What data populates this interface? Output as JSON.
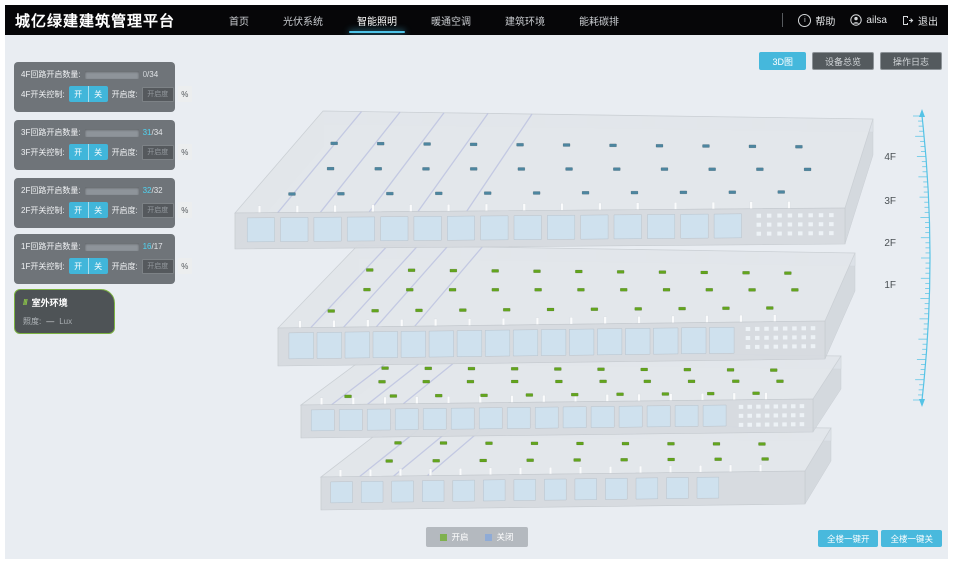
{
  "header": {
    "title": "城亿绿建建筑管理平台",
    "nav": [
      {
        "label": "首页"
      },
      {
        "label": "光伏系统"
      },
      {
        "label": "智能照明"
      },
      {
        "label": "暖通空调"
      },
      {
        "label": "建筑环境"
      },
      {
        "label": "能耗碳排"
      }
    ],
    "active_nav": "智能照明",
    "help_label": "帮助",
    "username": "ailsa",
    "logout_label": "退出"
  },
  "toolbar": {
    "view_3d": "3D图",
    "device_overview": "设备总览",
    "operation_log": "操作日志"
  },
  "floor_panels": [
    {
      "floor": "4F",
      "count_label": "4F回路开启数量:",
      "open": 0,
      "total": 34,
      "open_display": "0",
      "total_display": "/34",
      "switch_label": "4F开关控制:",
      "on_label": "开",
      "off_label": "关",
      "dim_label": "开启度:",
      "dim_placeholder": "开启度",
      "percent_label": "%"
    },
    {
      "floor": "3F",
      "count_label": "3F回路开启数量:",
      "open": 31,
      "total": 34,
      "open_display": "31",
      "total_display": "/34",
      "switch_label": "3F开关控制:",
      "on_label": "开",
      "off_label": "关",
      "dim_label": "开启度:",
      "dim_placeholder": "开启度",
      "percent_label": "%"
    },
    {
      "floor": "2F",
      "count_label": "2F回路开启数量:",
      "open": 32,
      "total": 32,
      "open_display": "32",
      "total_display": "/32",
      "switch_label": "2F开关控制:",
      "on_label": "开",
      "off_label": "关",
      "dim_label": "开启度:",
      "dim_placeholder": "开启度",
      "percent_label": "%"
    },
    {
      "floor": "1F",
      "count_label": "1F回路开启数量:",
      "open": 16,
      "total": 17,
      "open_display": "16",
      "total_display": "/17",
      "switch_label": "1F开关控制:",
      "on_label": "开",
      "off_label": "关",
      "dim_label": "开启度:",
      "dim_placeholder": "开启度",
      "percent_label": "%"
    }
  ],
  "outdoor": {
    "slash_icon": "///",
    "title": "室外环境",
    "metric_label": "照度:",
    "metric_value": "—",
    "metric_unit": "Lux"
  },
  "floor_axis_labels": [
    "4F",
    "3F",
    "2F",
    "1F"
  ],
  "legend": [
    {
      "label": "开启",
      "color": "#7fb14e"
    },
    {
      "label": "关闭",
      "color": "#8fabd6"
    }
  ],
  "bottom_actions": {
    "all_on": "全楼一键开",
    "all_off": "全楼一键关"
  },
  "colors": {
    "accent": "#45b8dc",
    "marker_open": "#63a51e",
    "marker_closed": "#4d86a0",
    "ruler": "#55c3e6"
  }
}
